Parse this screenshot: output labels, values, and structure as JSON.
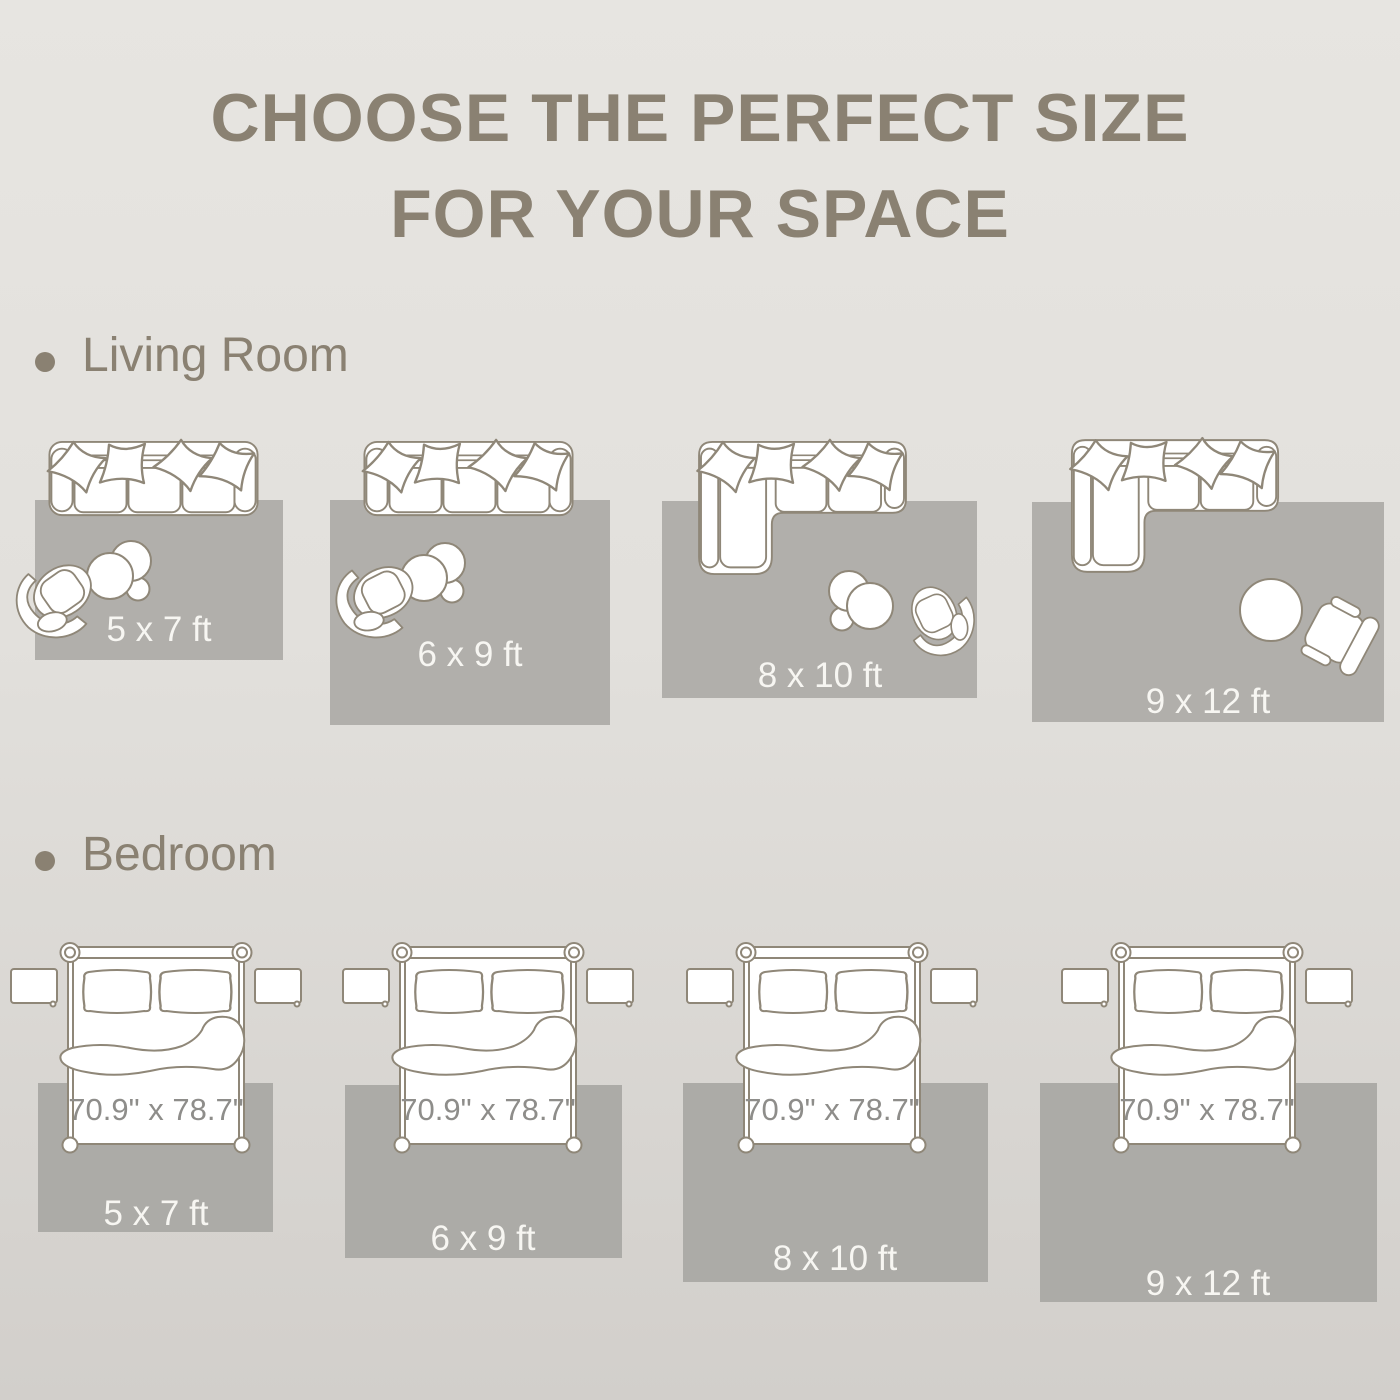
{
  "title": {
    "line1": "CHOOSE THE PERFECT SIZE",
    "line2": "FOR YOUR SPACE"
  },
  "sections": {
    "living_room": {
      "label": "Living Room",
      "layouts": [
        {
          "rug_label": "5 x 7 ft"
        },
        {
          "rug_label": "6 x 9 ft"
        },
        {
          "rug_label": "8 x 10 ft"
        },
        {
          "rug_label": "9 x 12 ft"
        }
      ]
    },
    "bedroom": {
      "label": "Bedroom",
      "layouts": [
        {
          "rug_label": "5 x 7 ft",
          "bed_label": "70.9\" x 78.7\""
        },
        {
          "rug_label": "6 x 9 ft",
          "bed_label": "70.9\" x 78.7\""
        },
        {
          "rug_label": "8 x 10 ft",
          "bed_label": "70.9\" x 78.7\""
        },
        {
          "rug_label": "9 x 12 ft",
          "bed_label": "70.9\" x 78.7\""
        }
      ]
    }
  },
  "colors": {
    "background_top": "#e7e5e1",
    "background_bottom": "#d2cfcb",
    "text": "#8a8172",
    "outline": "#8f8778",
    "furniture_fill": "#ffffff",
    "rug_living": "#b1afab",
    "rug_bedroom": "#acaba7",
    "rug_label": "#f7f6f2",
    "bed_dimension_text": "#8e8d8a"
  }
}
